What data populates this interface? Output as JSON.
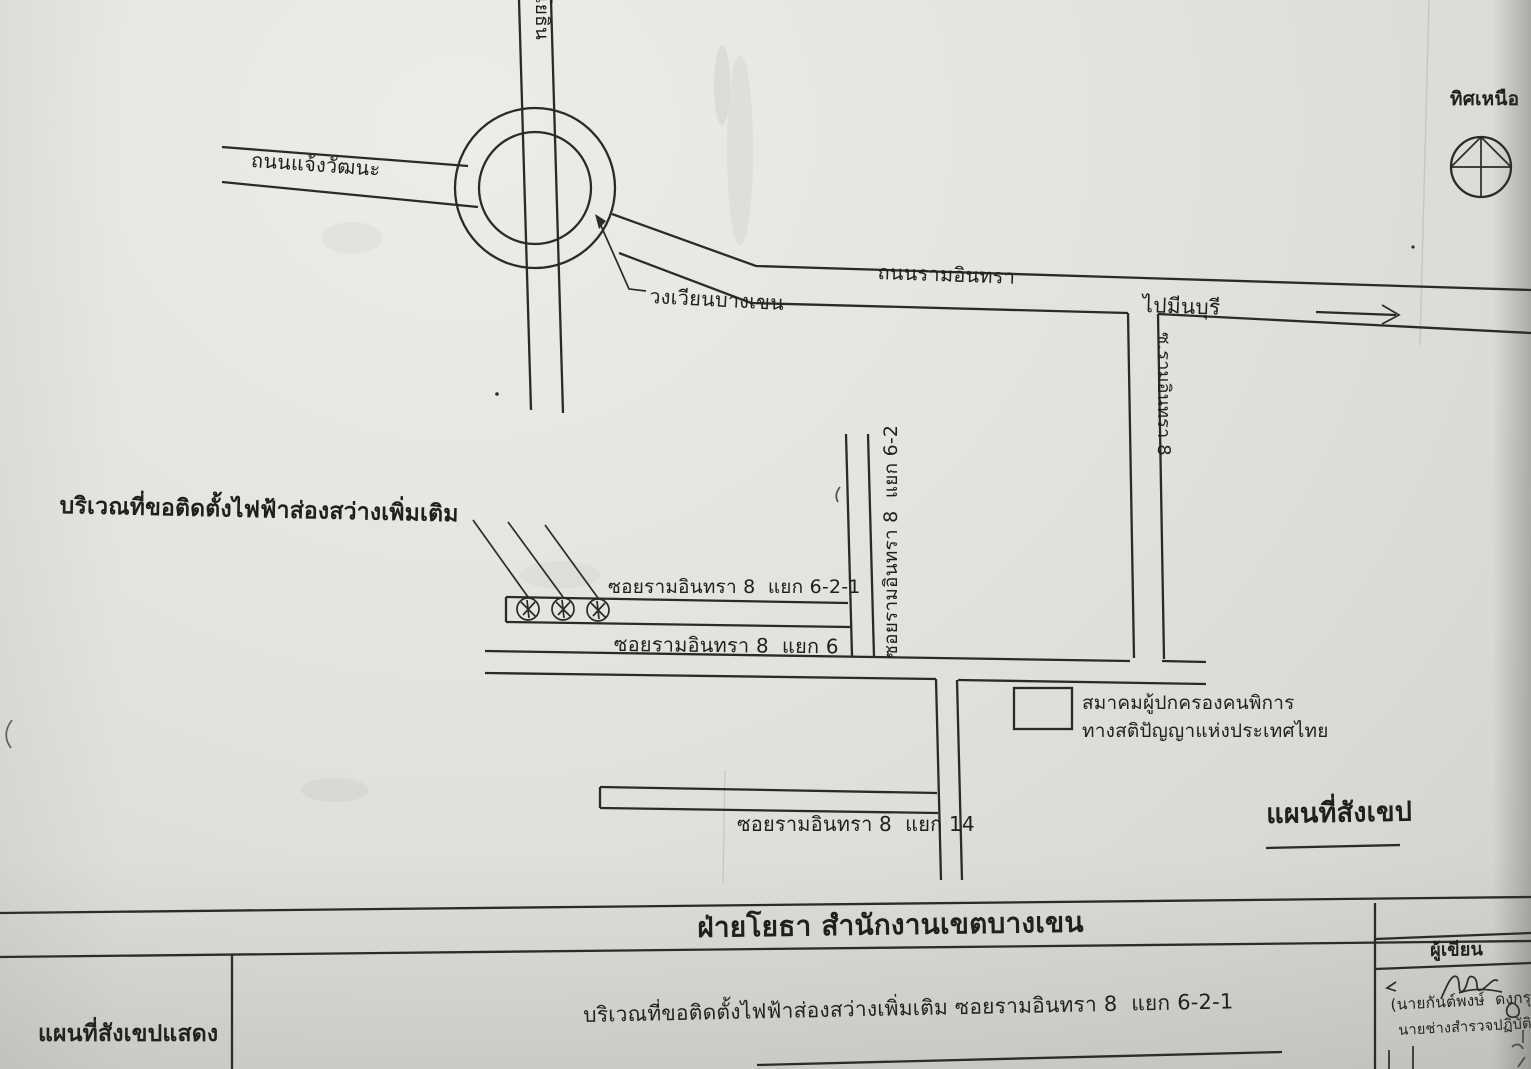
{
  "map": {
    "north_label": "ทิศเหนือ",
    "roundabout_label": "วงเวียนบางเขน",
    "request_area_label": "บริเวณที่ขอติดตั้งไฟฟ้าส่องสว่างเพิ่มเติม",
    "lamp_symbols": 3,
    "roads": {
      "chaeng_watthana": "ถนนแจ้งวัฒนะ",
      "phahonyothin": "ถนนพหลโยธิน",
      "ram_inthra": "ถนนรามอินทรา",
      "to_min_buri": "ไปมีนบุรี",
      "soi_ram_inthra_8": "ซ.รามอินทรา 8",
      "soi_6_2": "ซอยรามอินทรา 8  แยก 6-2",
      "soi_6_2_1": "ซอยรามอินทรา 8  แยก 6-2-1",
      "soi_6": "ซอยรามอินทรา 8  แยก 6",
      "soi_14": "ซอยรามอินทรา 8  แยก 14"
    },
    "association": {
      "line1": "สมาคมผู้ปกครองคนพิการ",
      "line2": "ทางสติปัญญาแห่งประเทศไทย"
    },
    "sketch_map_label": "แผนที่สังเขป"
  },
  "title_block": {
    "department": "ฝ่ายโยธา สำนักงานเขตบางเขน",
    "map_shows_label": "แผนที่สังเขปแสดง",
    "description": "บริเวณที่ขอติดตั้งไฟฟ้าส่องสว่างเพิ่มเติม ซอยรามอินทรา 8  แยก 6-2-1",
    "author_header": "ผู้เขียน",
    "author_name": "(นายกันต์พงษ์  ดงกรุดี)",
    "author_title": "นายช่างสำรวจปฏิบัติงาน"
  },
  "colors": {
    "paper": "#e2e2de",
    "ink": "#2b2b26"
  }
}
